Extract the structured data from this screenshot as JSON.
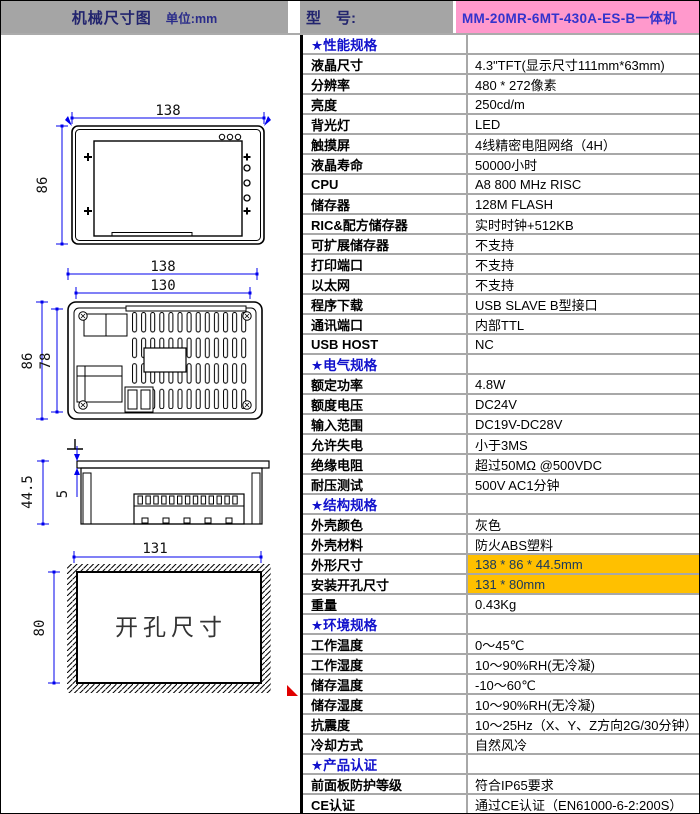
{
  "header": {
    "left_title": "机械尺寸图",
    "left_unit": "单位:mm",
    "model_label": "型　号:",
    "model_value": "MM-20MR-6MT-430A-ES-B一体机"
  },
  "drawing": {
    "front": {
      "width_dim": "138",
      "height_dim": "86"
    },
    "back": {
      "outer_width_dim": "138",
      "inner_width_dim": "130",
      "outer_height_dim": "86",
      "inner_height_dim": "78"
    },
    "side": {
      "depth_dim": "44.5",
      "bezel_dim": "5"
    },
    "cutout": {
      "width_dim": "131",
      "height_dim": "80",
      "label": "开孔尺寸"
    }
  },
  "colors": {
    "header_gray": "#a5a5a5",
    "model_pink": "#ff99cc",
    "model_text_blue": "#3333cc",
    "section_blue": "#1111cc",
    "highlight_orange": "#ffc000",
    "highlight_text_navy": "#17375e",
    "dimension_blue": "#0000ee",
    "marker_red": "#e00000"
  },
  "spec_table": {
    "rows": [
      {
        "section": "★性能规格"
      },
      {
        "label": "液晶尺寸",
        "value": "4.3\"TFT(显示尺寸111mm*63mm)"
      },
      {
        "label": "分辨率",
        "value": "480 * 272像素"
      },
      {
        "label": "亮度",
        "value": "250cd/m"
      },
      {
        "label": "背光灯",
        "value": "LED"
      },
      {
        "label": "触摸屏",
        "value": "4线精密电阻网络（4H）"
      },
      {
        "label": "液晶寿命",
        "value": "50000小时"
      },
      {
        "label": "CPU",
        "value": "A8 800 MHz RISC"
      },
      {
        "label": "储存器",
        "value": "128M FLASH"
      },
      {
        "label": "RIC&配方储存器",
        "value": "实时时钟+512KB"
      },
      {
        "label": "可扩展储存器",
        "value": "不支持"
      },
      {
        "label": "打印端口",
        "value": "不支持"
      },
      {
        "label": "以太网",
        "value": "不支持"
      },
      {
        "label": "程序下载",
        "value": "USB SLAVE B型接口"
      },
      {
        "label": "通讯端口",
        "value": "内部TTL"
      },
      {
        "label": "USB HOST",
        "value": "NC"
      },
      {
        "section": "★电气规格"
      },
      {
        "label": "额定功率",
        "value": "4.8W"
      },
      {
        "label": "额度电压",
        "value": "DC24V"
      },
      {
        "label": "输入范围",
        "value": "DC19V-DC28V"
      },
      {
        "label": "允许失电",
        "value": "小于3MS"
      },
      {
        "label": "绝缘电阻",
        "value": "超过50MΩ @500VDC"
      },
      {
        "label": "耐压测试",
        "value": "500V AC1分钟"
      },
      {
        "section": "★结构规格"
      },
      {
        "label": "外壳颜色",
        "value": "灰色"
      },
      {
        "label": "外壳材料",
        "value": "防火ABS塑料"
      },
      {
        "label": "外形尺寸",
        "value": "138 * 86 * 44.5mm",
        "highlight": true
      },
      {
        "label": "安装开孔尺寸",
        "value": "131 * 80mm",
        "highlight": true
      },
      {
        "label": "重量",
        "value": "0.43Kg"
      },
      {
        "section": "★环境规格"
      },
      {
        "label": "工作温度",
        "value": "0～45℃"
      },
      {
        "label": "工作湿度",
        "value": "10～90%RH(无冷凝)"
      },
      {
        "label": "储存温度",
        "value": "-10～60℃"
      },
      {
        "label": "储存湿度",
        "value": "10～90%RH(无冷凝)"
      },
      {
        "label": "抗震度",
        "value": "10～25Hz（X、Y、Z方向2G/30分钟）"
      },
      {
        "label": "冷却方式",
        "value": "自然风冷"
      },
      {
        "section": "★产品认证"
      },
      {
        "label": "前面板防护等级",
        "value": "符合IP65要求"
      },
      {
        "label": "CE认证",
        "value": "通过CE认证（EN61000-6-2:200S）"
      }
    ]
  }
}
